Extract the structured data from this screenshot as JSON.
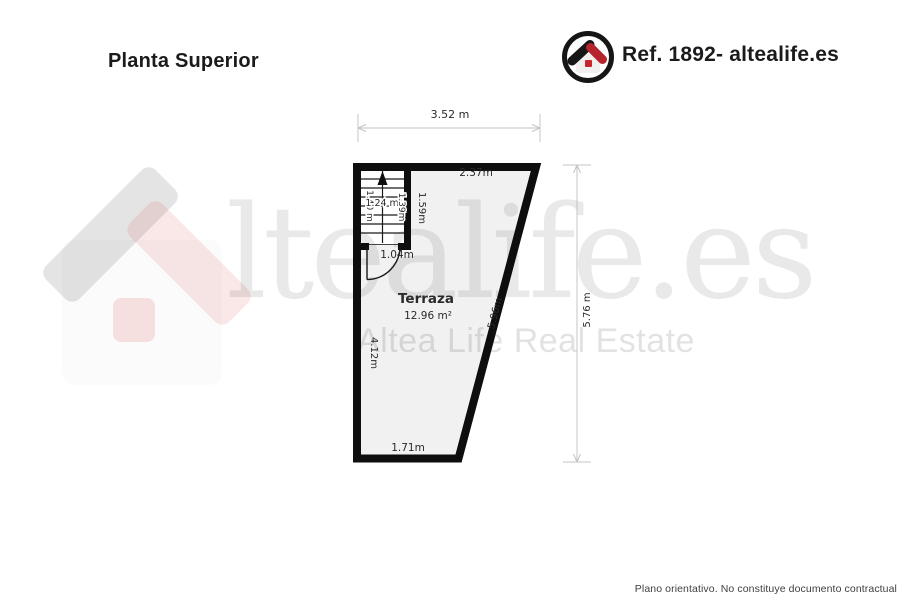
{
  "header": {
    "title": "Planta Superior",
    "reference": "Ref. 1892- altealife.es"
  },
  "watermark": {
    "brand_text": "ltealife.es",
    "subtitle": "Altea Life Real Estate"
  },
  "plan": {
    "room": {
      "name": "Terraza",
      "area": "12.96 m²"
    },
    "overall_dimensions": {
      "top_width": "3.52 m",
      "right_height": "5.76 m"
    },
    "edge_measurements": {
      "top_edge": "2.37m",
      "left_edge": "4.12m",
      "diagonal_edge": "5.96m",
      "bottom_edge": "1.71m"
    },
    "stairs": {
      "area": "1.24 m²",
      "left_flight_width": "1.40 m",
      "right_flight_width": "1.39m",
      "side_length": "1.59m"
    },
    "door": {
      "width": "1.04m"
    }
  },
  "footer": {
    "disclaimer": "Plano orientativo. No constituye documento contractual"
  },
  "colors": {
    "wall": "#0e0e0e",
    "room_fill": "#f1f1f1",
    "dimension_line": "#c4c4c4",
    "logo_red": "#b5242c",
    "logo_dark": "#161616",
    "watermark_gray": "#e8e8e8"
  }
}
